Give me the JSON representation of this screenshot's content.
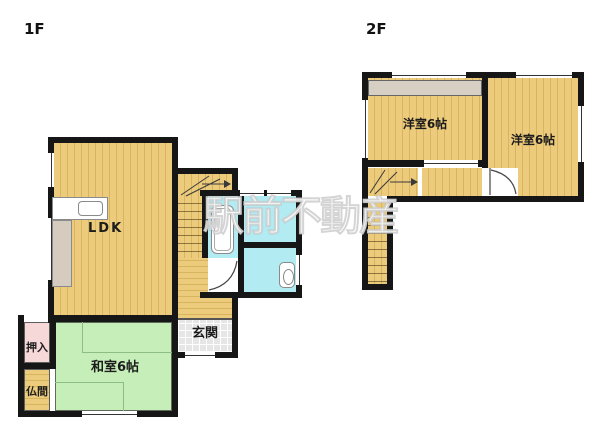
{
  "watermark": {
    "text": "駅前不動産"
  },
  "floor1": {
    "label": "1F",
    "rooms": {
      "ldk": {
        "label": "LDK"
      },
      "washitsu": {
        "label": "和室6帖"
      },
      "oshiire": {
        "label": "押入"
      },
      "butsuma": {
        "label": "仏間"
      },
      "genkan": {
        "label": "玄関"
      }
    }
  },
  "floor2": {
    "label": "2F",
    "rooms": {
      "west_room_left": {
        "label": "洋室6帖"
      },
      "west_room_right": {
        "label": "洋室6帖"
      }
    }
  },
  "colors": {
    "wood_floor": "#ECCB7D",
    "wood_stripe": "#D7B45E",
    "tatami_green": "#C5EEB8",
    "closet_pink": "#F7D8D8",
    "wet_area_cyan": "#B2EBF2",
    "genkan_gray": "#E6E6E6",
    "wall_black": "#161616",
    "closet_2f_gray": "#D7CFC4"
  }
}
